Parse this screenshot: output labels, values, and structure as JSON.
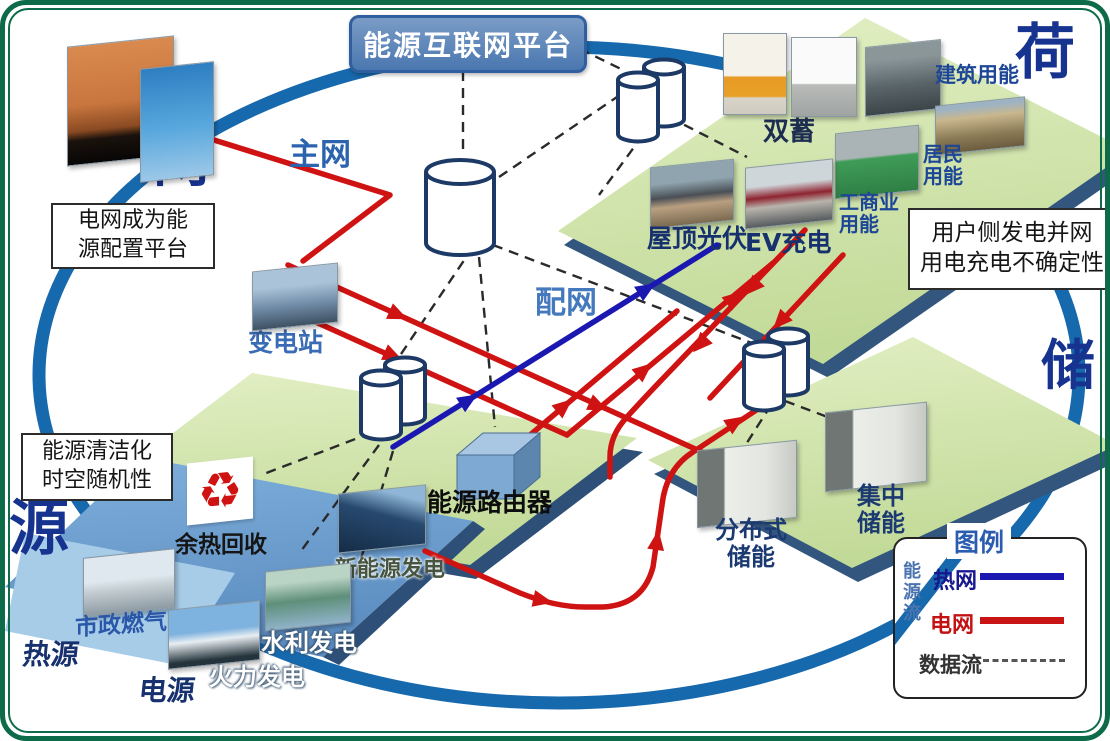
{
  "title": "能源互联网平台",
  "corner_labels": {
    "grid": "网",
    "load": "荷",
    "source": "源",
    "storage": "储"
  },
  "network": {
    "main_grid": "主网",
    "distribution": "配网",
    "substation": "变电站",
    "energy_router": "能源路由器"
  },
  "notes": {
    "grid": [
      "电网成为能",
      "源配置平台"
    ],
    "load": [
      "用户侧发电并网",
      "用电充电不确定性"
    ],
    "source": [
      "能源清洁化",
      "时空随机性"
    ]
  },
  "load_platform": {
    "dual_storage": "双蓄",
    "building_energy": "建筑用能",
    "residential_energy": [
      "居民",
      "用能"
    ],
    "industrial_energy": [
      "工商业",
      "用能"
    ],
    "rooftop_pv": "屋顶光伏",
    "ev_charging": "EV充电"
  },
  "storage_platform": {
    "distributed": [
      "分布式",
      "储能"
    ],
    "centralized": [
      "集中",
      "储能"
    ]
  },
  "source_platform": {
    "waste_heat_recovery": "余热回收",
    "municipal_gas": "市政燃气",
    "renewable_generation": "新能源发电",
    "hydro_generation": "水利发电",
    "thermal_generation": "火力发电",
    "power_source": "电源",
    "heat_source": "热源"
  },
  "legend": {
    "title": "图例",
    "energy_flow": "能源流",
    "items": [
      {
        "label": "热网",
        "line": "solid",
        "color": "#1a18b0"
      },
      {
        "label": "电网",
        "line": "solid",
        "color": "#c81414"
      },
      {
        "label": "数据流",
        "line": "dashed",
        "color": "#444444"
      }
    ]
  },
  "icons": {
    "recycle": "♻"
  },
  "colors": {
    "ring": "#1769ad",
    "power_line": "#cf1312",
    "heat_line": "#1a18b0",
    "data_line": "#2a2a2a",
    "platform_green": "#d2e5ae",
    "platform_edge": "#33567f",
    "platform_blue": "#6f9fd0",
    "frame_green": "#0e6b4a",
    "title_bg": "#4f7cb8"
  }
}
